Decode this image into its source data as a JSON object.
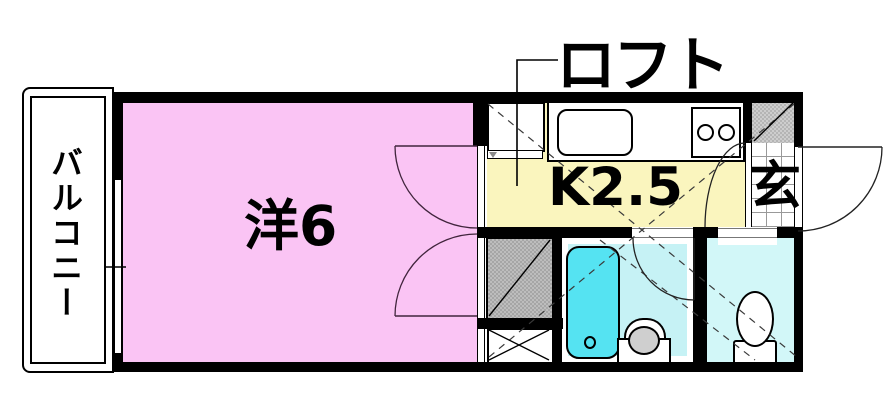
{
  "plan": {
    "title": "apartment floor plan",
    "labels": {
      "loft": "ロフト",
      "balcony": "バルコニー",
      "main_room": "洋6",
      "kitchen": "K2.5",
      "entrance": "玄"
    },
    "rooms": [
      {
        "name": "balcony",
        "label": "バルコニー"
      },
      {
        "name": "western-room",
        "label": "洋6"
      },
      {
        "name": "kitchen",
        "label": "K2.5"
      },
      {
        "name": "loft",
        "label": "ロフト"
      },
      {
        "name": "entrance",
        "label": "玄"
      }
    ],
    "colors": {
      "wall": "#000000",
      "roomPink": "#FAC4F4",
      "kitchenYellow": "#FAF5BE",
      "bathFloor": "#C6F2F5",
      "tubCyan": "#55E3F2",
      "toiletFloor": "#D2F7F8",
      "storageGray": "#B2B2B2",
      "shoeboxGray": "#C2C2C2",
      "basinGray": "#CFCFCF",
      "tileLine": "#999999"
    }
  }
}
